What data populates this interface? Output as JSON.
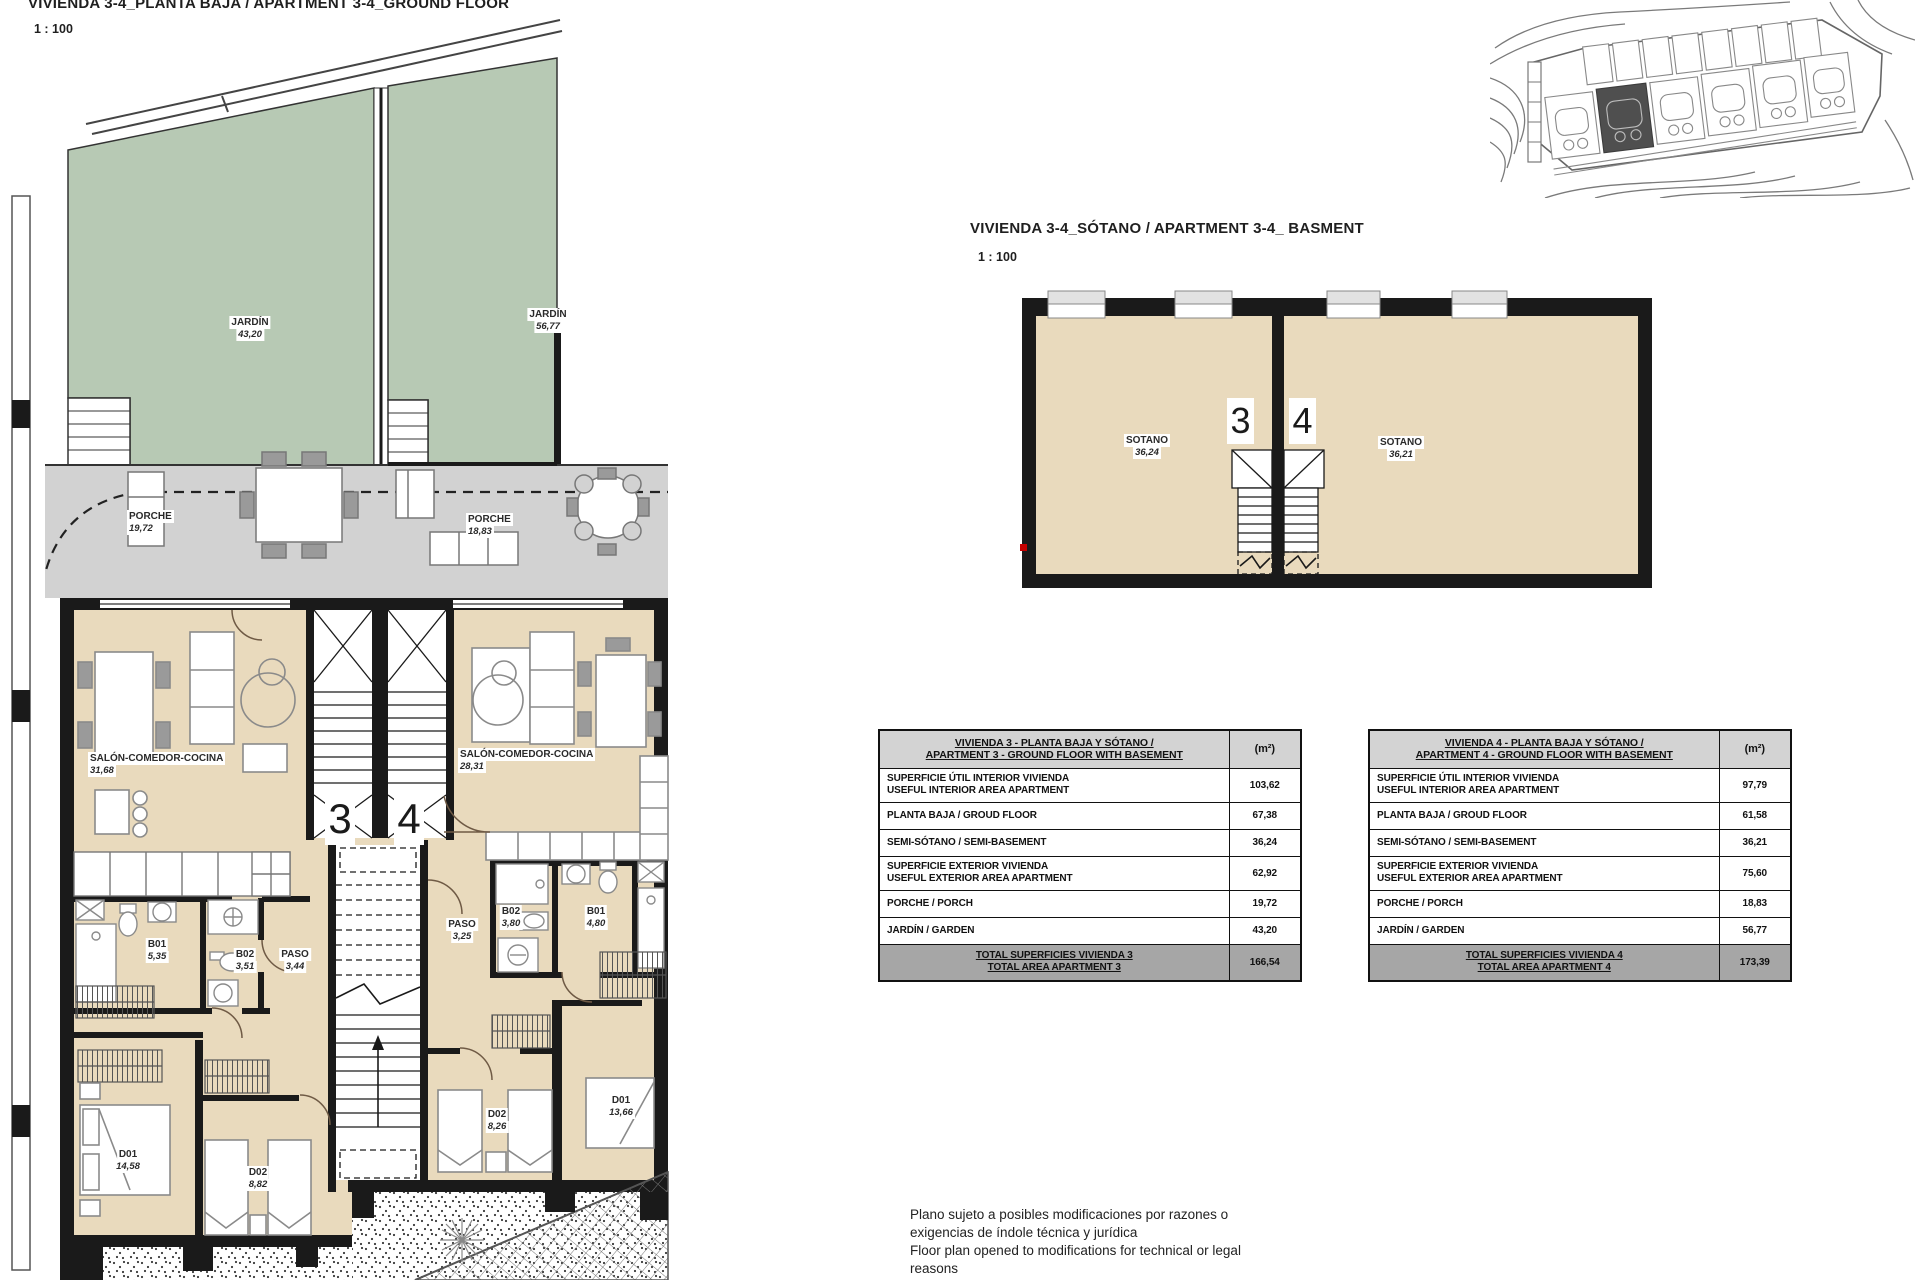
{
  "ground_floor": {
    "title": "VIVIENDA 3-4_PLANTA BAJA / APARTMENT 3-4_GROUND FLOOR",
    "scale": "1 : 100",
    "unit_left_number": "3",
    "unit_right_number": "4",
    "labels": {
      "jardin_left": {
        "name": "JARDÍN",
        "area": "43,20"
      },
      "jardin_right": {
        "name": "JARDÍN",
        "area": "56,77"
      },
      "porche_left": {
        "name": "PORCHE",
        "area": "19,72"
      },
      "porche_right": {
        "name": "PORCHE",
        "area": "18,83"
      },
      "salon_left": {
        "name": "SALÓN-COMEDOR-COCINA",
        "area": "31,68"
      },
      "salon_right": {
        "name": "SALÓN-COMEDOR-COCINA",
        "area": "28,31"
      },
      "b01_left": {
        "name": "B01",
        "area": "5,35"
      },
      "b02_left": {
        "name": "B02",
        "area": "3,51"
      },
      "paso_left": {
        "name": "PASO",
        "area": "3,44"
      },
      "d01_left": {
        "name": "D01",
        "area": "14,58"
      },
      "d02_left": {
        "name": "D02",
        "area": "8,82"
      },
      "paso_right": {
        "name": "PASO",
        "area": "3,25"
      },
      "b02_right": {
        "name": "B02",
        "area": "3,80"
      },
      "b01_right": {
        "name": "B01",
        "area": "4,80"
      },
      "d02_right": {
        "name": "D02",
        "area": "8,26"
      },
      "d01_right": {
        "name": "D01",
        "area": "13,66"
      }
    }
  },
  "basement": {
    "title": "VIVIENDA 3-4_SÓTANO  / APARTMENT 3-4_ BASMENT",
    "scale": "1 : 100",
    "unit_left_number": "3",
    "unit_right_number": "4",
    "labels": {
      "sotano_left": {
        "name": "SOTANO",
        "area": "36,24"
      },
      "sotano_right": {
        "name": "SOTANO",
        "area": "36,21"
      }
    }
  },
  "tables": [
    {
      "title_line1": "VIVIENDA 3 - PLANTA BAJA Y SÓTANO /",
      "title_line2": "APARTMENT 3 - GROUND FLOOR WITH BASEMENT",
      "unit_header": "(m²)",
      "rows": [
        {
          "label_line1": "SUPERFICIE ÚTIL INTERIOR VIVIENDA",
          "label_line2": "USEFUL INTERIOR AREA APARTMENT",
          "value": "103,62"
        },
        {
          "label_line1": "PLANTA BAJA / GROUD FLOOR",
          "value": "67,38"
        },
        {
          "label_line1": "SEMI-SÓTANO / SEMI-BASEMENT",
          "value": "36,24"
        },
        {
          "label_line1": "SUPERFICIE EXTERIOR VIVIENDA",
          "label_line2": "USEFUL EXTERIOR AREA APARTMENT",
          "value": "62,92"
        },
        {
          "label_line1": "PORCHE / PORCH",
          "value": "19,72"
        },
        {
          "label_line1": "JARDÍN / GARDEN",
          "value": "43,20"
        }
      ],
      "total_line1": "TOTAL SUPERFICIES VIVIENDA 3",
      "total_line2": "TOTAL AREA APARTMENT 3",
      "total_value": "166,54"
    },
    {
      "title_line1": "VIVIENDA 4 - PLANTA BAJA Y SÓTANO /",
      "title_line2": "APARTMENT 4 - GROUND FLOOR WITH BASEMENT",
      "unit_header": "(m²)",
      "rows": [
        {
          "label_line1": "SUPERFICIE ÚTIL INTERIOR VIVIENDA",
          "label_line2": "USEFUL INTERIOR AREA APARTMENT",
          "value": "97,79"
        },
        {
          "label_line1": "PLANTA BAJA / GROUD FLOOR",
          "value": "61,58"
        },
        {
          "label_line1": "SEMI-SÓTANO / SEMI-BASEMENT",
          "value": "36,21"
        },
        {
          "label_line1": "SUPERFICIE EXTERIOR VIVIENDA",
          "label_line2": "USEFUL EXTERIOR AREA APARTMENT",
          "value": "75,60"
        },
        {
          "label_line1": "PORCHE / PORCH",
          "value": "18,83"
        },
        {
          "label_line1": "JARDÍN / GARDEN",
          "value": "56,77"
        }
      ],
      "total_line1": "TOTAL SUPERFICIES VIVIENDA 4",
      "total_line2": "TOTAL AREA APARTMENT 4",
      "total_value": "173,39"
    }
  ],
  "disclaimer": {
    "line1": "Plano sujeto a posibles modificaciones por razones o",
    "line2": "exigencias de índole técnica y jurídica",
    "line3": "Floor plan opened to modifications for technical or legal",
    "line4": "reasons"
  },
  "colors": {
    "garden": "#b7c9b4",
    "porch": "#d2d2d2",
    "interior": "#e9dabd",
    "wall": "#1a1a1a",
    "highlight_unit": "#4f4f4f"
  }
}
